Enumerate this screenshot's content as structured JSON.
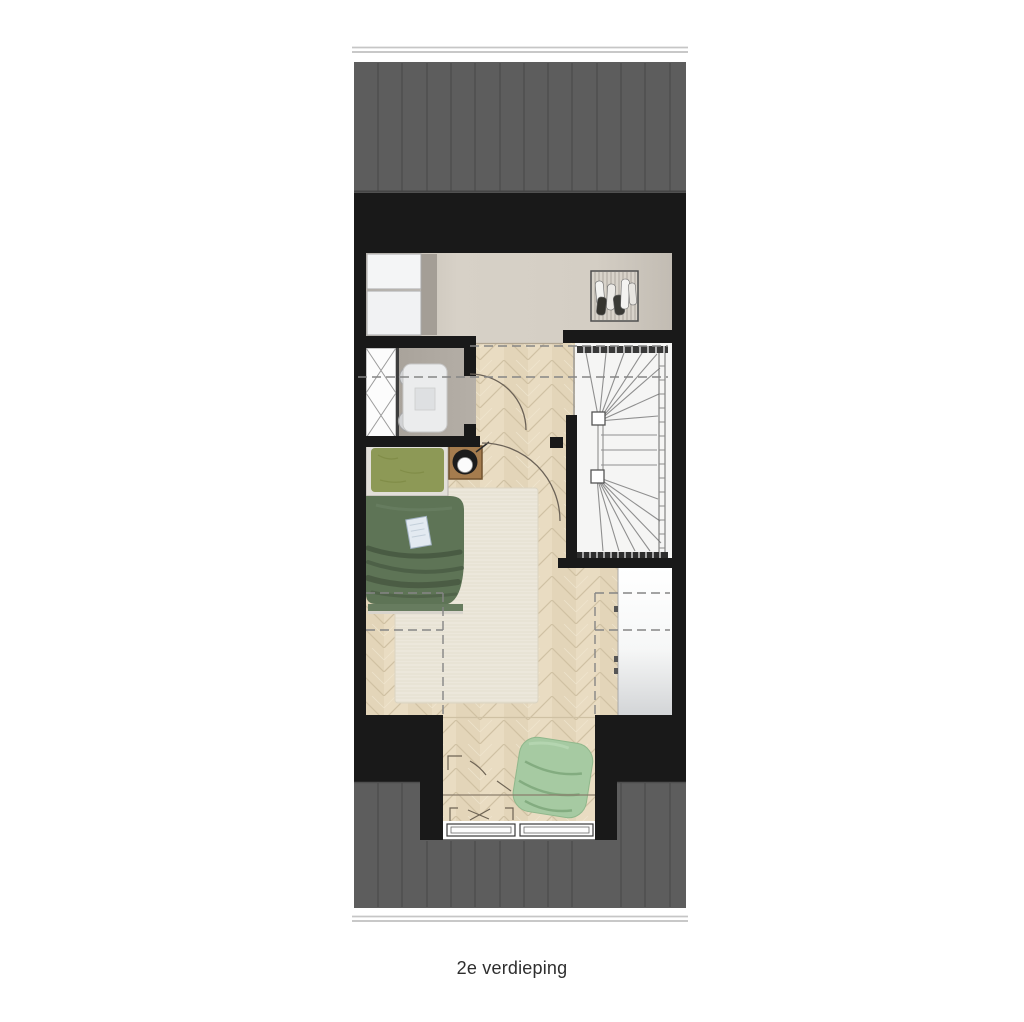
{
  "caption": {
    "text": "2e verdieping"
  },
  "floorplan": {
    "floor_name": "2e verdieping",
    "type": "architectural-floor-plan-top-view",
    "rooms": [
      {
        "name": "landing-laundry",
        "position": "top"
      },
      {
        "name": "bathroom",
        "position": "middle-left"
      },
      {
        "name": "staircase",
        "position": "middle-right"
      },
      {
        "name": "bedroom",
        "position": "center"
      },
      {
        "name": "dormer-alcove",
        "position": "bottom"
      }
    ],
    "furniture": [
      "washer-dryer-stack",
      "clothes-rack",
      "shower",
      "table-with-four-stools",
      "double-bed",
      "nightstand-with-lamp",
      "area-rug",
      "built-in-wardrobe",
      "beanbag-chair",
      "dormer-windows",
      "winder-staircase"
    ],
    "colors": {
      "background": "#ffffff",
      "roof": "#5d5d5d",
      "roof_seam": "#4a4a4a",
      "wall": "#191919",
      "wood_floor": "#e9dcc2",
      "landing_floor": "#d2ccc2",
      "bathroom_floor": "#aba59d",
      "stairwell": "#f5f5f4",
      "rug": "#ece7db",
      "bed_duvet": "#5e7456",
      "bed_pillow": "#8d9956",
      "beanbag": "#a6caa2",
      "nightstand": "#a57c4e",
      "closet": "#ffffff",
      "dash_line": "#858585",
      "caption_text": "#2e2e2e"
    }
  }
}
